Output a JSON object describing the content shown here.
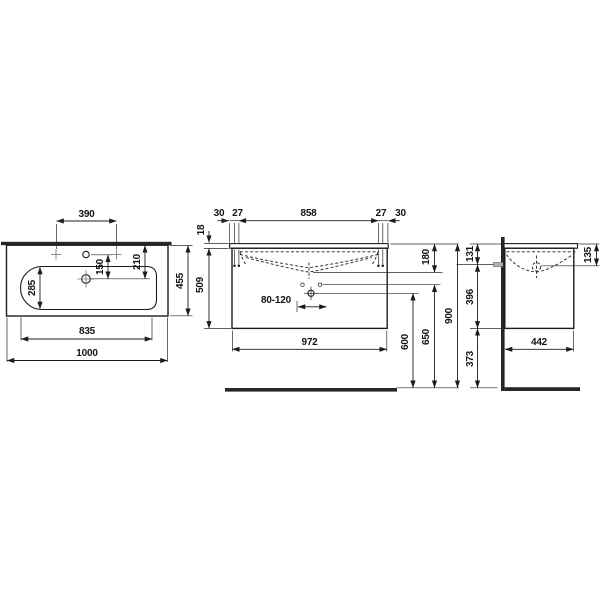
{
  "drawing": {
    "product": "washbasin with vanity unit - dimensional drawing",
    "colors": {
      "line": "#1c1c1c",
      "wall_fill": "#262626",
      "pipe_fill": "#b3b3b3"
    },
    "views": {
      "plan": {
        "dims": {
          "faucet_spacing": "390",
          "faucet_to_drain": "150",
          "rim_to_drain": "210",
          "bowl_depth": "285",
          "total_depth": "455",
          "bowl_width": "835",
          "total_width": "1000"
        }
      },
      "front": {
        "dims": {
          "edge_left": "30",
          "fix_left": "27",
          "fix_span": "858",
          "fix_right": "27",
          "edge_right": "30",
          "top_thickness": "18",
          "body_height": "509",
          "trap_range": "80-120",
          "cabinet_width": "972",
          "top_to_bowl_bottom": "180",
          "drain_height": "600",
          "fixing_height": "650",
          "mount_height": "900"
        }
      },
      "side": {
        "dims": {
          "top_to_outlet": "131",
          "top_to_outlet_right": "135",
          "outlet_to_bottom": "396",
          "bottom_to_floor": "373",
          "depth": "442"
        }
      }
    }
  }
}
